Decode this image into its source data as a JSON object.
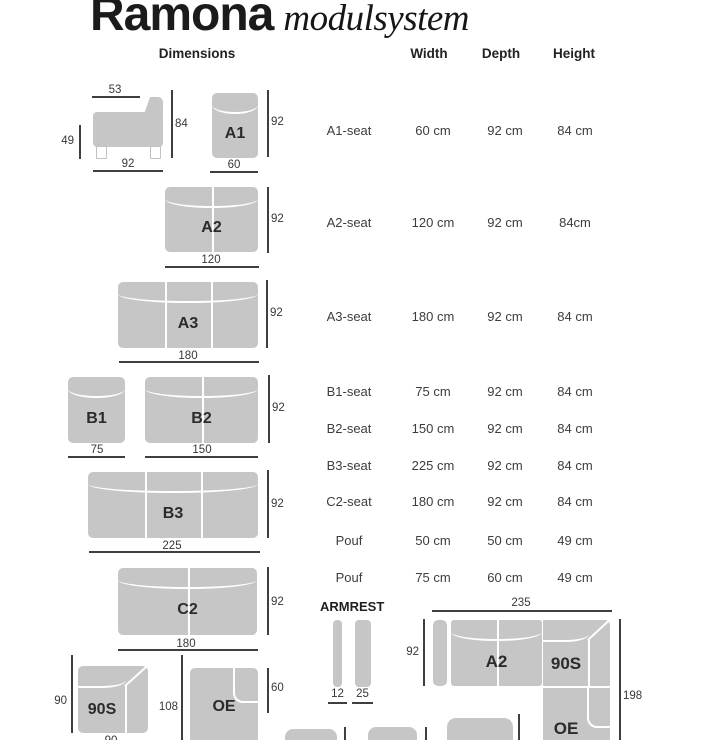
{
  "title": {
    "brand": "Ramona",
    "subtitle": "modulsystem"
  },
  "headers": {
    "dimensions": "Dimensions",
    "width": "Width",
    "depth": "Depth",
    "height": "Height"
  },
  "rows": [
    {
      "name": "A1-seat",
      "width": "60 cm",
      "depth": "92 cm",
      "height": "84 cm"
    },
    {
      "name": "A2-seat",
      "width": "120 cm",
      "depth": "92 cm",
      "height": "84cm"
    },
    {
      "name": "A3-seat",
      "width": "180 cm",
      "depth": "92 cm",
      "height": "84 cm"
    },
    {
      "name": "B1-seat",
      "width": "75 cm",
      "depth": "92 cm",
      "height": "84 cm"
    },
    {
      "name": "B2-seat",
      "width": "150 cm",
      "depth": "92 cm",
      "height": "84 cm"
    },
    {
      "name": "B3-seat",
      "width": "225 cm",
      "depth": "92 cm",
      "height": "84 cm"
    },
    {
      "name": "C2-seat",
      "width": "180 cm",
      "depth": "92 cm",
      "height": "84 cm"
    },
    {
      "name": "Pouf",
      "width": "50 cm",
      "depth": "50 cm",
      "height": "49 cm"
    },
    {
      "name": "Pouf",
      "width": "75 cm",
      "depth": "60 cm",
      "height": "49 cm"
    }
  ],
  "sideview": {
    "seat_depth": "53",
    "total_height": "84",
    "seat_height": "49",
    "depth": "92"
  },
  "modules": {
    "a1": {
      "label": "A1",
      "depth": "92",
      "width": "60"
    },
    "a2": {
      "label": "A2",
      "depth": "92",
      "width": "120"
    },
    "a3": {
      "label": "A3",
      "depth": "92",
      "width": "180"
    },
    "b1": {
      "label": "B1",
      "width": "75"
    },
    "b2": {
      "label": "B2",
      "depth": "92",
      "width": "150"
    },
    "b3": {
      "label": "B3",
      "depth": "92",
      "width": "225"
    },
    "c2": {
      "label": "C2",
      "depth": "92",
      "width": "180"
    },
    "s90": {
      "label": "90S",
      "side": "90",
      "bottom": "90"
    },
    "oe": {
      "label": "OE",
      "side": "108",
      "arm_height": "60"
    }
  },
  "armrest": {
    "title": "ARMREST",
    "w1": "12",
    "w2": "25"
  },
  "combo": {
    "top": "235",
    "left": "92",
    "right": "198",
    "a2": "A2",
    "s90": "90S",
    "oe": "OE"
  }
}
